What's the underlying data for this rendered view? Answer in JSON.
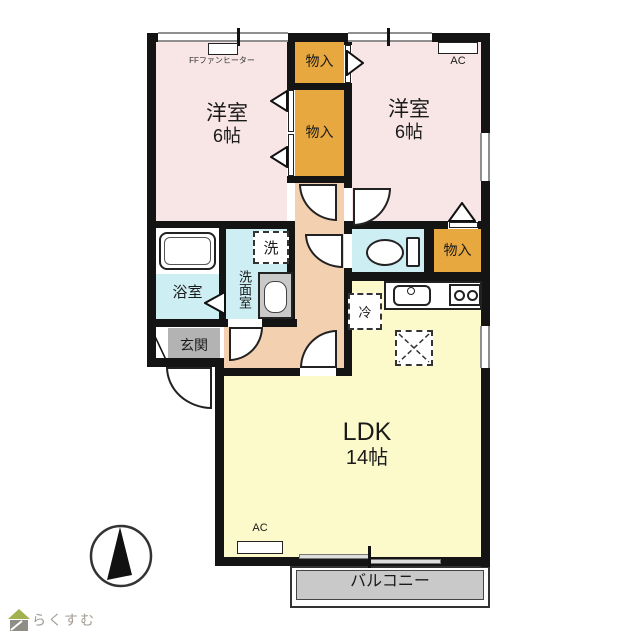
{
  "rooms": {
    "bedroom_left": {
      "name": "洋室",
      "size": "6帖"
    },
    "bedroom_right": {
      "name": "洋室",
      "size": "6帖"
    },
    "ldk": {
      "name": "LDK",
      "size": "14帖"
    },
    "bath": {
      "name": "浴室"
    },
    "washroom": {
      "name": "洗面室"
    },
    "entrance": {
      "name": "玄関"
    },
    "balcony": {
      "name": "バルコニー"
    },
    "closet_top": {
      "name": "物入"
    },
    "closet_middle": {
      "name": "物入"
    },
    "closet_side": {
      "name": "物入"
    }
  },
  "fixtures": {
    "ff_heater_label": "FFファンヒーター",
    "ac_label_bedroom": "AC",
    "ac_label_ldk": "AC",
    "washing_machine": "洗",
    "refrigerator": "冷"
  },
  "branding": {
    "logo_text": "らくすむ"
  },
  "colors": {
    "bedroom": "#f8e6e6",
    "closet": "#e7a83f",
    "hallway": "#f3d1b0",
    "wet_area": "#cdeef3",
    "ldk": "#fcf9cb",
    "entrance_floor": "#b3b3b3",
    "balcony_floor": "#c9c9c9",
    "wall": "#141414"
  }
}
